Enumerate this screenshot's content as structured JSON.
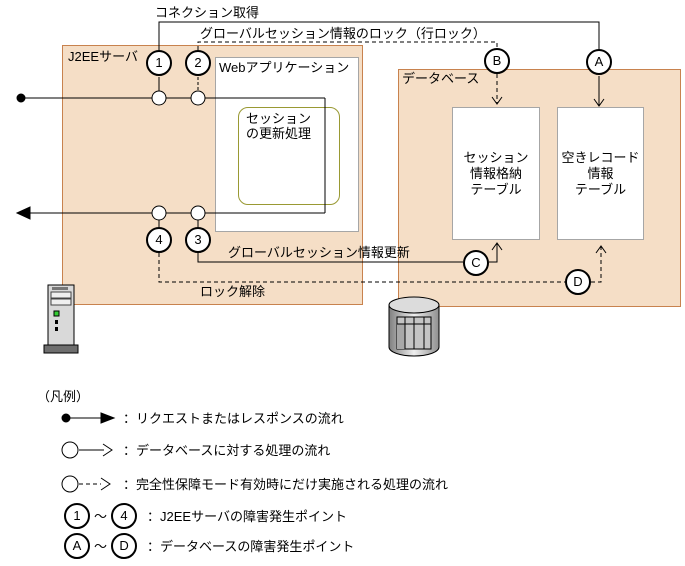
{
  "diagram": {
    "top_labels": {
      "connection_acquire": "コネクション取得",
      "global_session_lock": "グローバルセッション情報のロック（行ロック）"
    },
    "j2ee": {
      "title": "J2EEサーバ",
      "web_app_title": "Webアプリケーション",
      "session_update": [
        "セッション",
        "の更新処理"
      ]
    },
    "db": {
      "title": "データベース",
      "session_table": [
        "セッション",
        "情報格納",
        "テーブル"
      ],
      "free_table": [
        "空きレコード",
        "情報",
        "テーブル"
      ]
    },
    "flow_labels": {
      "global_session_update": "グローバルセッション情報更新",
      "lock_release": "ロック解除"
    },
    "points": {
      "p1": "1",
      "p2": "2",
      "p3": "3",
      "p4": "4",
      "pa": "A",
      "pb": "B",
      "pc": "C",
      "pd": "D"
    }
  },
  "legend": {
    "title": "（凡例）",
    "rows": [
      {
        "icon": "request-response-arrow",
        "label": "：リクエストまたはレスポンスの流れ"
      },
      {
        "icon": "db-process-arrow",
        "label": "：データベースに対する処理の流れ"
      },
      {
        "icon": "integrity-mode-arrow",
        "label": "：完全性保障モード有効時にだけ実施される処理の流れ"
      },
      {
        "from": "1",
        "tilde": "～",
        "to": "4",
        "label": "：J2EEサーバの障害発生ポイント"
      },
      {
        "from": "A",
        "tilde": "～",
        "to": "D",
        "label": "：データベースの障害発生ポイント"
      }
    ]
  },
  "colors": {
    "zone_fill": "#F5DEC6",
    "zone_border": "#C8824E",
    "inner_border": "#A6A6A6",
    "session_border": "#999933",
    "line": "#000000",
    "led_green": "#33CC33"
  }
}
